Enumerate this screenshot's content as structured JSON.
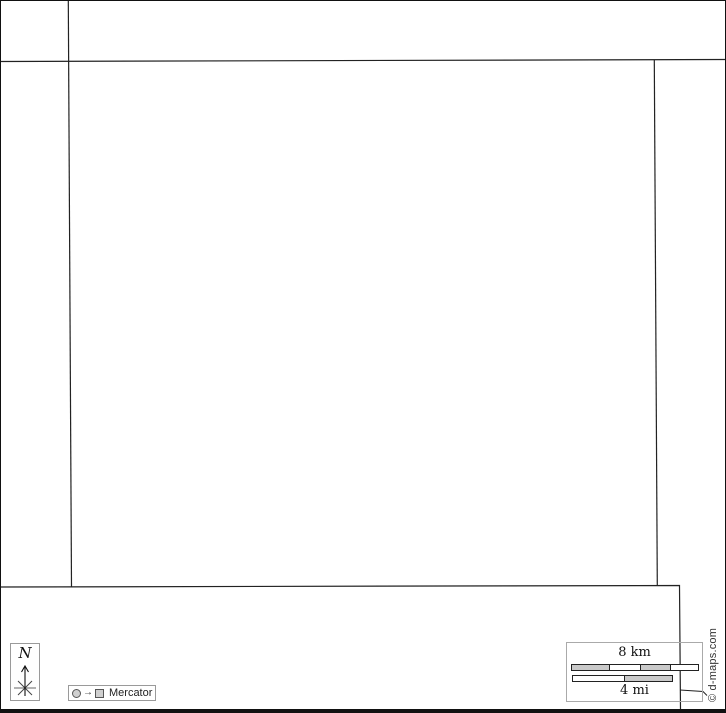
{
  "map": {
    "title": "blank-outline-map",
    "copyright": "© d-maps.com",
    "north_indicator": {
      "label": "N"
    },
    "projection": {
      "label": "Mercator",
      "arrow_glyph": "→"
    },
    "scale_bar": {
      "km_label": "8 km",
      "km_total_km": 8,
      "km_segments": [
        "gray",
        "white",
        "gray",
        "white"
      ],
      "mi_label": "4 mi",
      "mi_total_mi": 4,
      "mi_segments": [
        "white",
        "gray"
      ]
    },
    "colors": {
      "boundary_line": "#222222",
      "frame_border": "#111111",
      "legend_box_border": "#9a9a9a",
      "bar_border": "#222222",
      "bar_gray": "#c9c9c9",
      "bar_white": "#ffffff",
      "background": "#ffffff",
      "copyright_text": "#333333"
    }
  }
}
